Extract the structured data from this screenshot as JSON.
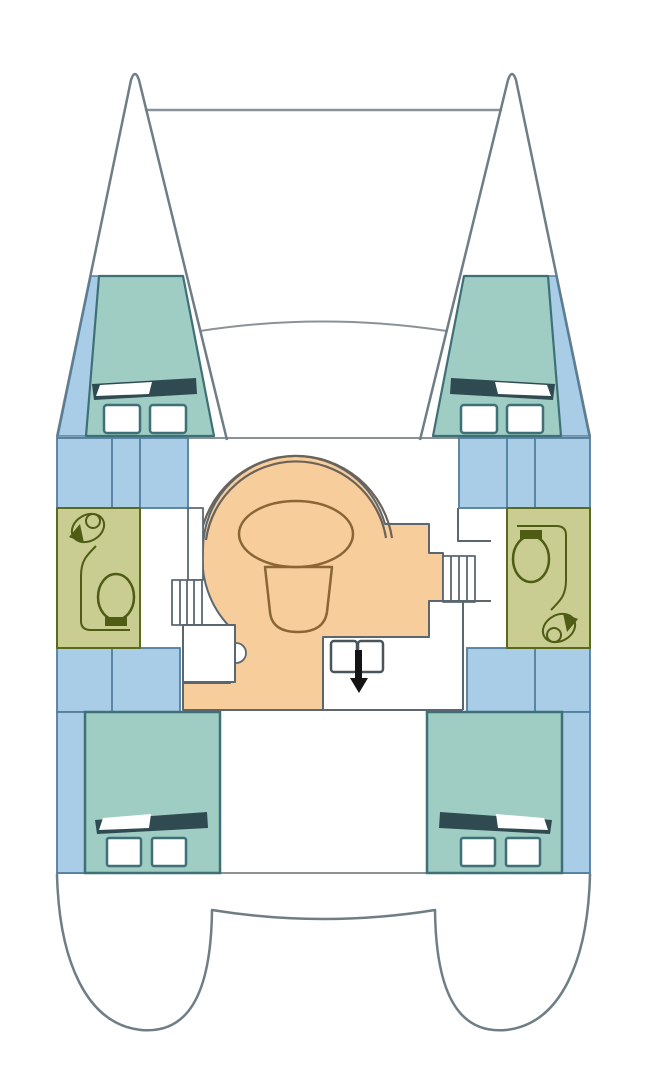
{
  "plan": {
    "type": "catamaran-deck-plan",
    "features": [
      "port-bow",
      "starboard-bow",
      "forward-crossbeam",
      "coachroof-front",
      "port-forward-cabin",
      "starboard-forward-cabin",
      "port-head",
      "starboard-head",
      "salon-settee",
      "dinette-table",
      "stool-seat",
      "port-companionway-stairs",
      "starboard-companionway-stairs",
      "nav-seat",
      "galley-double-sink",
      "entry-arrow",
      "port-aft-cabin",
      "starboard-aft-cabin",
      "port-stern",
      "starboard-stern"
    ]
  },
  "colors": {
    "background": "#ffffff",
    "white": "#ffffff",
    "hull_line": "#6f7d85",
    "deck_line": "#8a9299",
    "cabin_teal": "#9fccc3",
    "cabin_border": "#3f7078",
    "berth_blue": "#a9cde7",
    "berth_border": "#527e9e",
    "bathroom_olive": "#c9cd92",
    "bathroom_border": "#5c6a20",
    "fixture_olive": "#4e5c14",
    "salon_orange": "#f8cd9c",
    "salon_border": "#5b6770",
    "furniture_brown": "#8a6536",
    "settee_line": "#6b6258",
    "bed_dark": "#2f4a50",
    "sink_gray": "#4a545c",
    "arrow_black": "#141414"
  }
}
